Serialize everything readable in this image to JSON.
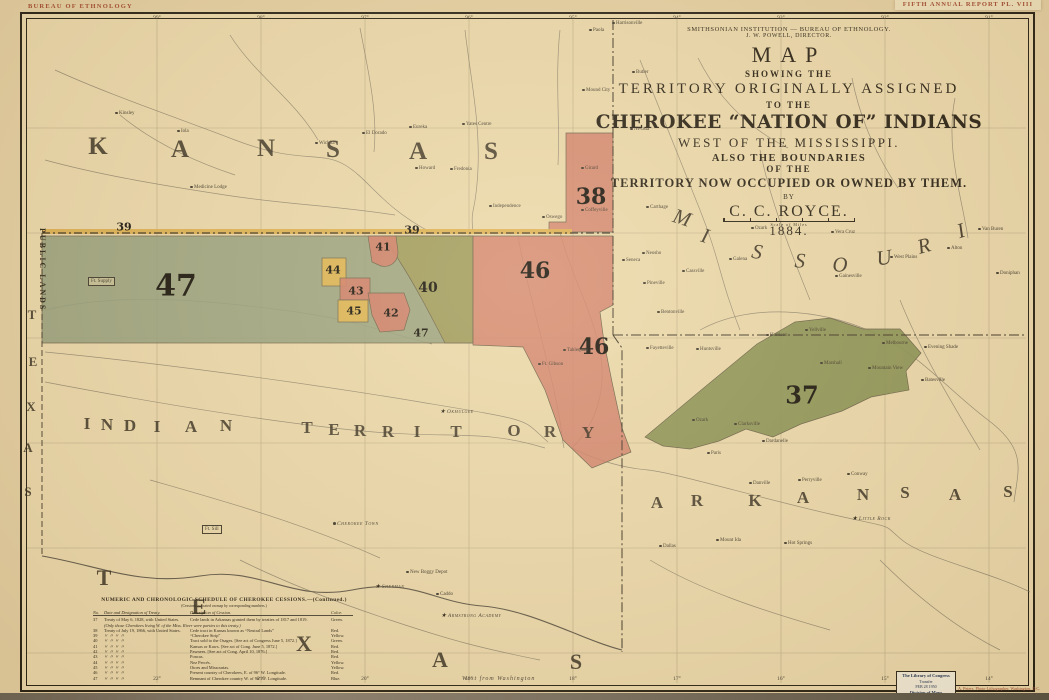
{
  "header": {
    "plate_left": "BUREAU OF ETHNOLOGY",
    "plate_right": "FIFTH ANNUAL REPORT   PL. VIII"
  },
  "title_block": {
    "institution": "SMITHSONIAN INSTITUTION — BUREAU OF ETHNOLOGY.",
    "director": "J. W. POWELL,   DIRECTOR.",
    "map": "MAP",
    "showing": "SHOWING THE",
    "territory": "TERRITORY ORIGINALLY ASSIGNED",
    "tothe": "TO THE",
    "cherokee": "CHEROKEE “NATION OF” INDIANS",
    "west": "WEST OF THE MISSISSIPPI.",
    "also": "ALSO THE BOUNDARIES",
    "ofthe": "OF THE",
    "now": "TERRITORY NOW OCCUPIED OR OWNED BY THEM.",
    "by": "BY",
    "author": "C. C. ROYCE.",
    "year": "1884.",
    "scale_caption": "Scale of Miles"
  },
  "map": {
    "state_letters": [
      {
        "t": "K",
        "x": 98,
        "y": 147,
        "s": 25
      },
      {
        "t": "A",
        "x": 180,
        "y": 150,
        "s": 25
      },
      {
        "t": "N",
        "x": 266,
        "y": 149,
        "s": 25
      },
      {
        "t": "S",
        "x": 333,
        "y": 150,
        "s": 25
      },
      {
        "t": "A",
        "x": 418,
        "y": 152,
        "s": 25
      },
      {
        "t": "S",
        "x": 491,
        "y": 152,
        "s": 25
      },
      {
        "t": "M",
        "x": 682,
        "y": 218,
        "s": 21,
        "i": 1,
        "r": 18
      },
      {
        "t": "I",
        "x": 705,
        "y": 236,
        "s": 21,
        "i": 1,
        "r": 16
      },
      {
        "t": "S",
        "x": 757,
        "y": 252,
        "s": 21,
        "i": 1,
        "r": 10
      },
      {
        "t": "S",
        "x": 800,
        "y": 261,
        "s": 21,
        "i": 1,
        "r": 4
      },
      {
        "t": "O",
        "x": 840,
        "y": 265,
        "s": 21,
        "i": 1,
        "r": -2
      },
      {
        "t": "U",
        "x": 884,
        "y": 258,
        "s": 21,
        "i": 1,
        "r": -9
      },
      {
        "t": "R",
        "x": 924,
        "y": 246,
        "s": 21,
        "i": 1,
        "r": -15
      },
      {
        "t": "I",
        "x": 961,
        "y": 231,
        "s": 21,
        "i": 1,
        "r": -18
      },
      {
        "t": "A",
        "x": 657,
        "y": 503,
        "s": 17
      },
      {
        "t": "R",
        "x": 697,
        "y": 501,
        "s": 17
      },
      {
        "t": "K",
        "x": 755,
        "y": 501,
        "s": 17
      },
      {
        "t": "A",
        "x": 803,
        "y": 498,
        "s": 17
      },
      {
        "t": "N",
        "x": 863,
        "y": 495,
        "s": 17
      },
      {
        "t": "S",
        "x": 905,
        "y": 493,
        "s": 17
      },
      {
        "t": "A",
        "x": 955,
        "y": 495,
        "s": 17
      },
      {
        "t": "S",
        "x": 1008,
        "y": 492,
        "s": 17
      },
      {
        "t": "I",
        "x": 87,
        "y": 424,
        "s": 17
      },
      {
        "t": "N",
        "x": 107,
        "y": 425,
        "s": 17
      },
      {
        "t": "D",
        "x": 130,
        "y": 426,
        "s": 17
      },
      {
        "t": "I",
        "x": 157,
        "y": 427,
        "s": 17
      },
      {
        "t": "A",
        "x": 191,
        "y": 427,
        "s": 17
      },
      {
        "t": "N",
        "x": 226,
        "y": 426,
        "s": 17
      },
      {
        "t": "T",
        "x": 307,
        "y": 428,
        "s": 17
      },
      {
        "t": "E",
        "x": 334,
        "y": 430,
        "s": 17
      },
      {
        "t": "R",
        "x": 360,
        "y": 431,
        "s": 17
      },
      {
        "t": "R",
        "x": 388,
        "y": 432,
        "s": 17
      },
      {
        "t": "I",
        "x": 417,
        "y": 432,
        "s": 17
      },
      {
        "t": "T",
        "x": 456,
        "y": 432,
        "s": 17
      },
      {
        "t": "O",
        "x": 514,
        "y": 431,
        "s": 17
      },
      {
        "t": "R",
        "x": 550,
        "y": 432,
        "s": 17
      },
      {
        "t": "Y",
        "x": 588,
        "y": 433,
        "s": 17
      },
      {
        "t": "T",
        "x": 104,
        "y": 578,
        "s": 22
      },
      {
        "t": "E",
        "x": 199,
        "y": 607,
        "s": 22
      },
      {
        "t": "X",
        "x": 304,
        "y": 644,
        "s": 22
      },
      {
        "t": "A",
        "x": 440,
        "y": 660,
        "s": 22
      },
      {
        "t": "S",
        "x": 576,
        "y": 662,
        "s": 22
      },
      {
        "t": "T",
        "x": 32,
        "y": 315,
        "s": 13
      },
      {
        "t": "E",
        "x": 33,
        "y": 362,
        "s": 13
      },
      {
        "t": "X",
        "x": 31,
        "y": 407,
        "s": 13
      },
      {
        "t": "A",
        "x": 28,
        "y": 448,
        "s": 13
      },
      {
        "t": "S",
        "x": 28,
        "y": 492,
        "s": 13
      }
    ],
    "public_lands": "PUBLIC LANDS",
    "region_labels": [
      {
        "n": "39",
        "x": 124,
        "y": 227,
        "s": 11
      },
      {
        "n": "39",
        "x": 412,
        "y": 230,
        "s": 11
      },
      {
        "n": "47",
        "x": 176,
        "y": 286,
        "s": 30
      },
      {
        "n": "47",
        "x": 421,
        "y": 333,
        "s": 11
      },
      {
        "n": "40",
        "x": 428,
        "y": 288,
        "s": 14
      },
      {
        "n": "41",
        "x": 383,
        "y": 247,
        "s": 11
      },
      {
        "n": "44",
        "x": 333,
        "y": 270,
        "s": 11
      },
      {
        "n": "43",
        "x": 356,
        "y": 291,
        "s": 11
      },
      {
        "n": "45",
        "x": 354,
        "y": 311,
        "s": 11
      },
      {
        "n": "42",
        "x": 391,
        "y": 313,
        "s": 11
      },
      {
        "n": "46",
        "x": 535,
        "y": 271,
        "s": 22
      },
      {
        "n": "46",
        "x": 594,
        "y": 347,
        "s": 22
      },
      {
        "n": "38",
        "x": 591,
        "y": 197,
        "s": 22
      },
      {
        "n": "37",
        "x": 802,
        "y": 395,
        "s": 24
      }
    ],
    "towns": [
      {
        "n": "Harrisonville",
        "x": 612,
        "y": 21
      },
      {
        "n": "Paola",
        "x": 589,
        "y": 28
      },
      {
        "n": "Butler",
        "x": 632,
        "y": 70
      },
      {
        "n": "Mound City",
        "x": 582,
        "y": 88
      },
      {
        "n": "Kinsley",
        "x": 115,
        "y": 111
      },
      {
        "n": "Nevada",
        "x": 630,
        "y": 127
      },
      {
        "n": "Iola",
        "x": 177,
        "y": 129
      },
      {
        "n": "Wichita",
        "x": 315,
        "y": 141
      },
      {
        "n": "El Dorado",
        "x": 362,
        "y": 131
      },
      {
        "n": "Eureka",
        "x": 409,
        "y": 125
      },
      {
        "n": "Yates Centre",
        "x": 462,
        "y": 122
      },
      {
        "n": "Girard",
        "x": 581,
        "y": 166
      },
      {
        "n": "Howard",
        "x": 415,
        "y": 166
      },
      {
        "n": "Fredonia",
        "x": 450,
        "y": 167
      },
      {
        "n": "Medicine Lodge",
        "x": 190,
        "y": 185
      },
      {
        "n": "Independence",
        "x": 489,
        "y": 204
      },
      {
        "n": "Coffeyville",
        "x": 581,
        "y": 208
      },
      {
        "n": "Oswego",
        "x": 542,
        "y": 215
      },
      {
        "n": "Carthage",
        "x": 646,
        "y": 205
      },
      {
        "n": "Neosho",
        "x": 642,
        "y": 251
      },
      {
        "n": "Seneca",
        "x": 622,
        "y": 258
      },
      {
        "n": "Pineville",
        "x": 643,
        "y": 281
      },
      {
        "n": "Cassville",
        "x": 682,
        "y": 269
      },
      {
        "n": "Galena",
        "x": 729,
        "y": 257
      },
      {
        "n": "Ozark",
        "x": 751,
        "y": 226
      },
      {
        "n": "Vera Cruz",
        "x": 831,
        "y": 230
      },
      {
        "n": "Gainesville",
        "x": 835,
        "y": 274
      },
      {
        "n": "West Plains",
        "x": 890,
        "y": 255
      },
      {
        "n": "Alton",
        "x": 947,
        "y": 246
      },
      {
        "n": "Doniphan",
        "x": 996,
        "y": 271
      },
      {
        "n": "Van Buren",
        "x": 978,
        "y": 227
      },
      {
        "n": "Bentonville",
        "x": 657,
        "y": 310
      },
      {
        "n": "Fayetteville",
        "x": 646,
        "y": 346
      },
      {
        "n": "Huntsville",
        "x": 696,
        "y": 347
      },
      {
        "n": "Harrison",
        "x": 766,
        "y": 333
      },
      {
        "n": "Yellville",
        "x": 805,
        "y": 328
      },
      {
        "n": "Marshall",
        "x": 820,
        "y": 361
      },
      {
        "n": "Mountain View",
        "x": 868,
        "y": 366
      },
      {
        "n": "Melbourne",
        "x": 882,
        "y": 341
      },
      {
        "n": "Evening Shade",
        "x": 924,
        "y": 345
      },
      {
        "n": "Batesville",
        "x": 921,
        "y": 378
      },
      {
        "n": "Clarksville",
        "x": 734,
        "y": 422
      },
      {
        "n": "Ozark",
        "x": 692,
        "y": 418
      },
      {
        "n": "Paris",
        "x": 707,
        "y": 451
      },
      {
        "n": "Dardanelle",
        "x": 762,
        "y": 439
      },
      {
        "n": "Danville",
        "x": 749,
        "y": 481
      },
      {
        "n": "Perryville",
        "x": 798,
        "y": 478
      },
      {
        "n": "Conway",
        "x": 847,
        "y": 472
      },
      {
        "n": "Little Rock",
        "x": 852,
        "y": 517,
        "star": 1,
        "caps": 1
      },
      {
        "n": "Hot Springs",
        "x": 784,
        "y": 541
      },
      {
        "n": "Mount Ida",
        "x": 716,
        "y": 538
      },
      {
        "n": "Dallas",
        "x": 659,
        "y": 544
      },
      {
        "n": "Ft. Supply",
        "x": 88,
        "y": 277,
        "box": 1
      },
      {
        "n": "Tahlequah",
        "x": 563,
        "y": 348
      },
      {
        "n": "Ft. Gibson",
        "x": 538,
        "y": 362
      },
      {
        "n": "Okmulgee",
        "x": 440,
        "y": 410,
        "star": 1,
        "caps": 1
      },
      {
        "n": "Cherokee Town",
        "x": 333,
        "y": 522,
        "caps": 1
      },
      {
        "n": "New Boggy Depot",
        "x": 406,
        "y": 570
      },
      {
        "n": "Caddo",
        "x": 436,
        "y": 592
      },
      {
        "n": "Armstrong Academy",
        "x": 441,
        "y": 614,
        "star": 1,
        "caps": 1
      },
      {
        "n": "Sherman",
        "x": 375,
        "y": 585,
        "star": 1,
        "caps": 1
      },
      {
        "n": "Ft. Sill",
        "x": 202,
        "y": 525,
        "box": 1
      }
    ],
    "graticule_top": [
      {
        "t": "99°",
        "x": 157
      },
      {
        "t": "98°",
        "x": 261
      },
      {
        "t": "97°",
        "x": 365
      },
      {
        "t": "96°",
        "x": 469
      },
      {
        "t": "95°",
        "x": 573
      },
      {
        "t": "94°",
        "x": 677
      },
      {
        "t": "93°",
        "x": 781
      },
      {
        "t": "92°",
        "x": 885
      },
      {
        "t": "91°",
        "x": 989
      }
    ],
    "graticule_bottom": [
      {
        "t": "22°",
        "x": 157
      },
      {
        "t": "21°",
        "x": 261
      },
      {
        "t": "20°",
        "x": 365
      },
      {
        "t": "19°",
        "x": 469
      },
      {
        "t": "18°",
        "x": 573
      },
      {
        "t": "17°",
        "x": 677
      },
      {
        "t": "16°",
        "x": 781
      },
      {
        "t": "15°",
        "x": 885
      },
      {
        "t": "14°",
        "x": 989
      }
    ],
    "west_note": "West from Washington"
  },
  "schedule": {
    "title": "NUMERIC AND CHRONOLOGIC SCHEDULE OF CHEROKEE CESSIONS.—(Continued.)",
    "subtitle": "(Cessions indicated on map by corresponding numbers.)",
    "headers": [
      "No.",
      "Date and Designation of Treaty.",
      "Description of Cession.",
      "Color."
    ],
    "ditto": "〃      〃      〃      〃",
    "rows": [
      {
        "no": "37",
        "treaty": "Treaty of May 6, 1828, with United States.",
        "desc": "Cede lands in Arkansas granted them by treaties of 1817 and 1819.",
        "color": "Green."
      },
      {
        "note": "(Only those Cherokees living W. of the Miss. River were parties to this treaty.)"
      },
      {
        "no": "38",
        "treaty": "Treaty of July 19, 1866, with United States.",
        "desc": "Cede tract in Kansas known as “Neutral Lands”",
        "color": "Red."
      },
      {
        "no": "39",
        "ditto": true,
        "desc": "“Cherokee Strip”",
        "color": "Yellow."
      },
      {
        "no": "40",
        "ditto": true,
        "desc": "Tract sold to the Osages. [See act of Congress June 5, 1872.]",
        "color": "Green."
      },
      {
        "no": "41",
        "ditto": true,
        "desc": "Kansas or Kaws. [See act of Cong. June 5, 1872.]",
        "color": "Red."
      },
      {
        "no": "42",
        "ditto": true,
        "desc": "Pawnees. [See act of Cong. April 10, 1876.]",
        "color": "Red."
      },
      {
        "no": "43",
        "ditto": true,
        "desc": "Poncas.",
        "color": "Red."
      },
      {
        "no": "44",
        "ditto": true,
        "desc": "Nez Percés.",
        "color": "Yellow."
      },
      {
        "no": "45",
        "ditto": true,
        "desc": "Otoes and Missourias.",
        "color": "Yellow."
      },
      {
        "no": "46",
        "ditto": true,
        "desc": "Present country of Cherokees, E. of 96° W. Longitude.",
        "color": "Red."
      },
      {
        "no": "47",
        "ditto": true,
        "desc": "Remnant of Cherokee country W. of 96° W. Longitude.",
        "color": "Blue."
      }
    ]
  },
  "stamp": {
    "l1": "The Library of Congress",
    "l2": "Transfer",
    "l3": "FEB 28 1950",
    "l4": "Division of Maps"
  },
  "imprint": "A. Peters, Photo-Lithographer, Washington, D.C.",
  "colors": {
    "paper": "#e5d0a3",
    "map_face": "#ecd9ac",
    "ink": "#2b2317",
    "accent_red": "#a3492f",
    "cession_red": "#d1806a",
    "cession_yellow": "#e2b650",
    "cession_olive": "#a09b58",
    "cession_green": "#868f50",
    "cession_blue_gray": "#949e7c",
    "border_yellow": "#ddb04e"
  }
}
